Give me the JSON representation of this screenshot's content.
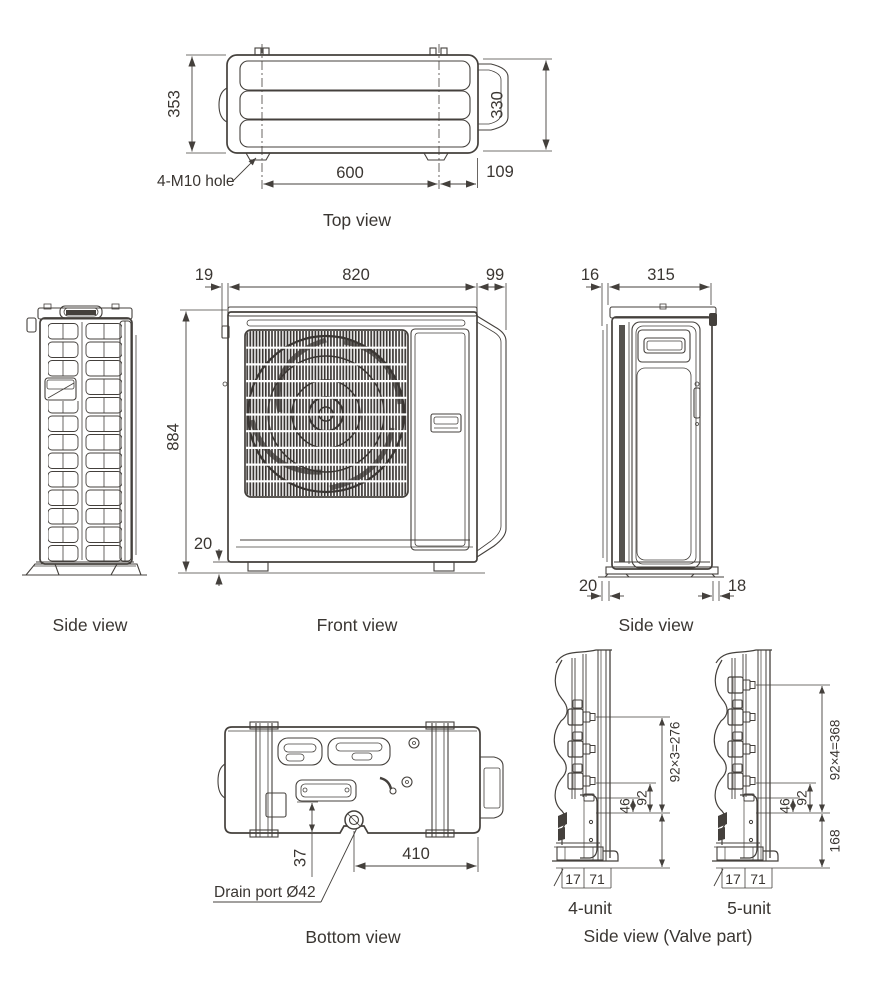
{
  "colors": {
    "line": "#44403c",
    "text": "#3a3632",
    "background": "#ffffff"
  },
  "views": {
    "top": {
      "caption": "Top view",
      "hole_label": "4-M10 hole",
      "dim_depth": "353",
      "dim_depth_inner": "330",
      "dim_foot_pitch": "600",
      "dim_side_offset": "109"
    },
    "side_left": {
      "caption": "Side view"
    },
    "front": {
      "caption": "Front view",
      "dim_offset_left": "19",
      "dim_width": "820",
      "dim_offset_right": "99",
      "dim_height": "884",
      "dim_foot": "20"
    },
    "side_right": {
      "caption": "Side view",
      "dim_offset_top": "16",
      "dim_depth": "315",
      "dim_foot_front": "20",
      "dim_foot_rear": "18"
    },
    "bottom": {
      "caption": "Bottom view",
      "drain_label": "Drain port Ø42",
      "dim_drain_depth": "37",
      "dim_drain_x": "410"
    },
    "valve": {
      "caption": "Side view (Valve part)",
      "unit4": {
        "caption": "4-unit",
        "dim_total": "92×3=276",
        "dim_pitch": "92",
        "dim_half": "46",
        "dim_d1": "17",
        "dim_d2": "71"
      },
      "unit5": {
        "caption": "5-unit",
        "dim_total": "92×4=368",
        "dim_pitch": "92",
        "dim_half": "46",
        "dim_base": "168",
        "dim_d1": "17",
        "dim_d2": "71"
      }
    }
  }
}
